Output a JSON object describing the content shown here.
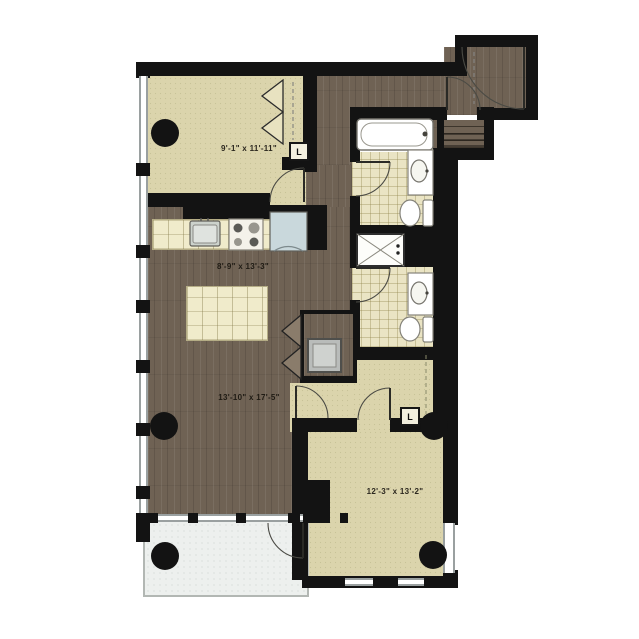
{
  "floorplan": {
    "rooms": [
      {
        "name": "bedroom-1",
        "dimensions": "9'-1\" x 11'-11\""
      },
      {
        "name": "kitchen",
        "dimensions": "8'-9\" x 13'-3\""
      },
      {
        "name": "living-room",
        "dimensions": "13'-10\" x 17'-5\""
      },
      {
        "name": "bedroom-2",
        "dimensions": "12'-3\" x 13'-2\""
      }
    ],
    "closets": [
      {
        "name": "linen-closet-bedroom-1",
        "label": "L"
      },
      {
        "name": "linen-closet-bedroom-2",
        "label": "L"
      }
    ],
    "palette": {
      "wall": "#131313",
      "beige": "#dbd4ac",
      "tile": "#eae4c4",
      "wood": "#6f6254",
      "counter": "#f0ebcb",
      "balcony": "#edf0ee",
      "fridge": "#c9d8dc",
      "winline": "#9aa0a0"
    }
  }
}
